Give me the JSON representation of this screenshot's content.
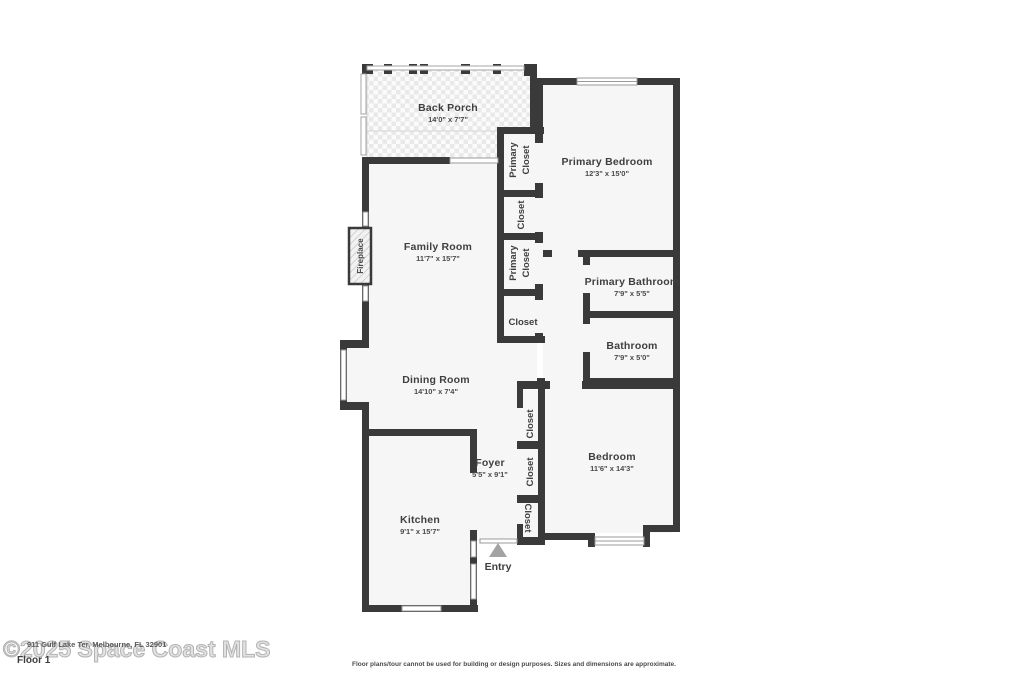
{
  "page": {
    "floor_label": "Floor 1",
    "watermark": "©2025 Space Coast MLS",
    "address": "911 Gulf Lake Ter, Melbourne, FL 32901",
    "disclaimer": "Floor plans/tour cannot be used for building or design purposes. Sizes and dimensions are approximate."
  },
  "colors": {
    "wall": "#3a3a3a",
    "floor": "#f6f6f6",
    "label_text": "#3f3f3f",
    "watermark": "#b3b3b3",
    "entry_arrow": "#a3a3a3"
  },
  "rooms": {
    "back_porch": {
      "name": "Back Porch",
      "dims": "14'0\" x 7'7\""
    },
    "primary_bedroom": {
      "name": "Primary Bedroom",
      "dims": "12'3\" x 15'0\""
    },
    "family_room": {
      "name": "Family Room",
      "dims": "11'7\" x 15'7\""
    },
    "primary_bathroom": {
      "name": "Primary Bathroom",
      "dims": "7'9\" x 5'5\""
    },
    "bathroom": {
      "name": "Bathroom",
      "dims": "7'9\" x 5'0\""
    },
    "dining_room": {
      "name": "Dining Room",
      "dims": "14'10\" x 7'4\""
    },
    "bedroom": {
      "name": "Bedroom",
      "dims": "11'6\" x 14'3\""
    },
    "foyer": {
      "name": "Foyer",
      "dims": "5'5\" x 9'1\""
    },
    "kitchen": {
      "name": "Kitchen",
      "dims": "9'1\" x 15'7\""
    }
  },
  "labels": {
    "fireplace": "Fireplace",
    "entry": "Entry",
    "primary_closet_upper_line1": "Primary",
    "primary_closet_upper_line2": "Closet",
    "closet_upper": "Closet",
    "primary_closet_mid_line1": "Primary",
    "primary_closet_mid_line2": "Closet",
    "closet_hall": "Closet",
    "closet_foyer_top": "Closet",
    "closet_foyer_mid": "Closet",
    "closet_foyer_bottom": "Closet"
  }
}
